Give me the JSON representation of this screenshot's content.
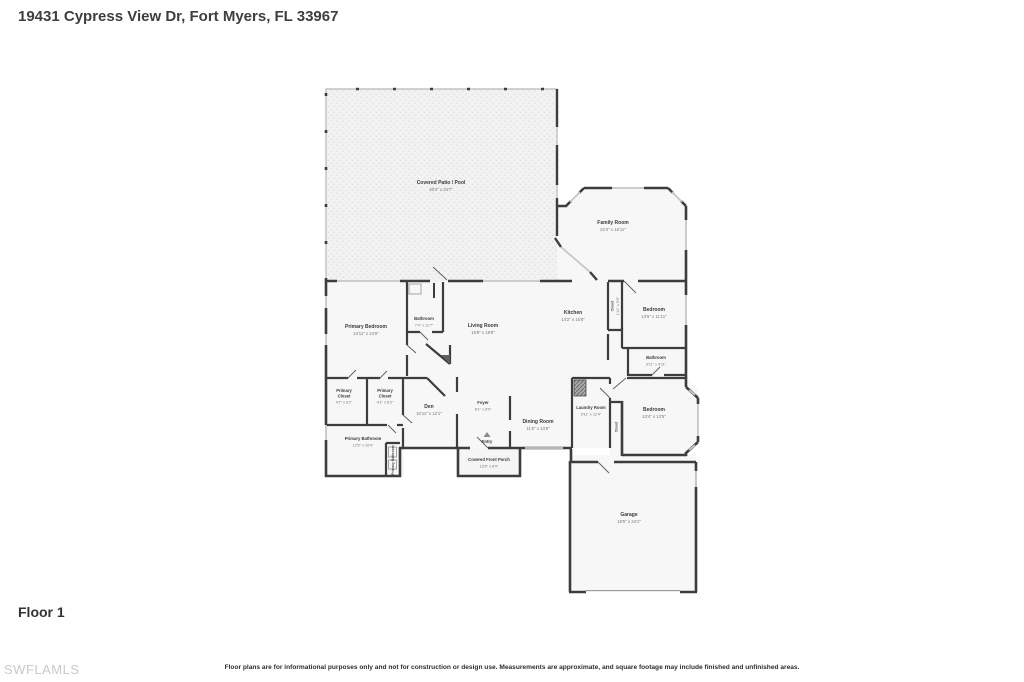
{
  "header": {
    "title": "19431 Cypress View Dr, Fort Myers, FL 33967"
  },
  "footer": {
    "floor_label": "Floor 1",
    "watermark": "SWFLAMLS",
    "disclaimer": "Floor plans are for informational purposes only and not for construction or design use. Measurements are approximate, and square footage may include finished and unfinished areas."
  },
  "colors": {
    "wall": "#3d3d3d",
    "window": "#c6c6c6",
    "room_fill": "#f7f7f7",
    "patio_fill": "#f2f2f2"
  },
  "rooms": {
    "covered_patio": {
      "name": "Covered Patio / Pool",
      "dims": "40'4\" x 34'7\""
    },
    "family_room": {
      "name": "Family Room",
      "dims": "22'4\" x 16'11\""
    },
    "primary_bedroom": {
      "name": "Primary Bedroom",
      "dims": "13'11\" x 24'6\""
    },
    "bathroom_top": {
      "name": "Bathroom",
      "dims": "7'4\" x 11'7\""
    },
    "living_room": {
      "name": "Living Room",
      "dims": "15'8\" x 18'8\""
    },
    "kitchen": {
      "name": "Kitchen",
      "dims": "14'2\" x 15'8\""
    },
    "closet_kitchen": {
      "name": "Closet",
      "dims": "1'11\" x 9'9\""
    },
    "bedroom_top": {
      "name": "Bedroom",
      "dims": "13'6\" x 11'11\""
    },
    "bathroom_right": {
      "name": "Bathroom",
      "dims": "9'11\" x 4'11\""
    },
    "primary_closet_left": {
      "l1": "Primary",
      "l2": "Closet",
      "dims": "4'7\" x 6'2\""
    },
    "primary_closet_right": {
      "l1": "Primary",
      "l2": "Closet",
      "dims": "4'1\" x 6'2\""
    },
    "primary_bathroom": {
      "name": "Primary Bathroom",
      "dims": "12'5\" x 10'4\""
    },
    "water_closet": {
      "name": "Primary Bathroom"
    },
    "den": {
      "name": "Den",
      "dims": "10'11\" x 12'1\""
    },
    "foyer": {
      "name": "Foyer",
      "dims": "8'1\" x 8'0\""
    },
    "entry": {
      "name": "Entry"
    },
    "front_porch": {
      "name": "Covered Front Porch",
      "dims": "13'6\" x 8'9\""
    },
    "dining_room": {
      "name": "Dining Room",
      "dims": "11'8\" x 13'8\""
    },
    "laundry_room": {
      "name": "Laundry Room",
      "dims": "5'11\" x 12'4\""
    },
    "closet_hall": {
      "name": "Closet"
    },
    "bedroom_bottom": {
      "name": "Bedroom",
      "dims": "13'4\" x 13'5\""
    },
    "garage": {
      "name": "Garage",
      "dims": "19'5\" x 24'1\""
    }
  }
}
